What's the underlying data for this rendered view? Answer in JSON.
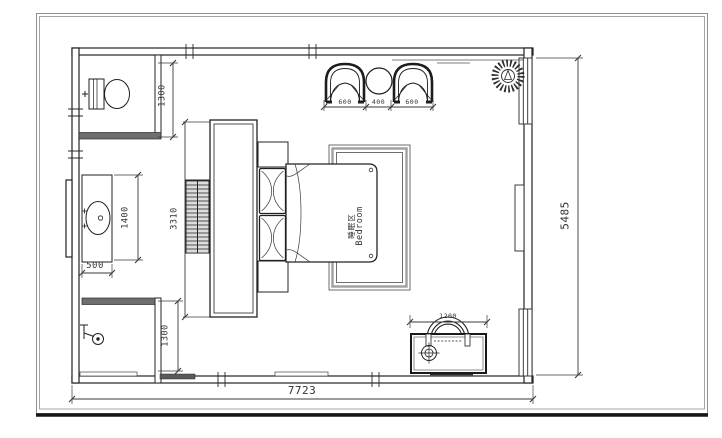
{
  "drawing": {
    "room": {
      "label_cn": "睡眠区",
      "label_en": "Bedroom"
    },
    "dimensions": {
      "overall_width": "7723",
      "overall_depth": "5485",
      "wc_depth": "1300",
      "vanity_length": "1400",
      "vanity_width": "500",
      "shower_depth": "1300",
      "wardrobe_length": "3310",
      "armchair_left": "600",
      "side_table": "400",
      "armchair_right": "600",
      "dresser_width": "1200"
    },
    "colors": {
      "line": "#232323",
      "partition_fill": "#6e6e6e",
      "rug": "#979797"
    }
  }
}
